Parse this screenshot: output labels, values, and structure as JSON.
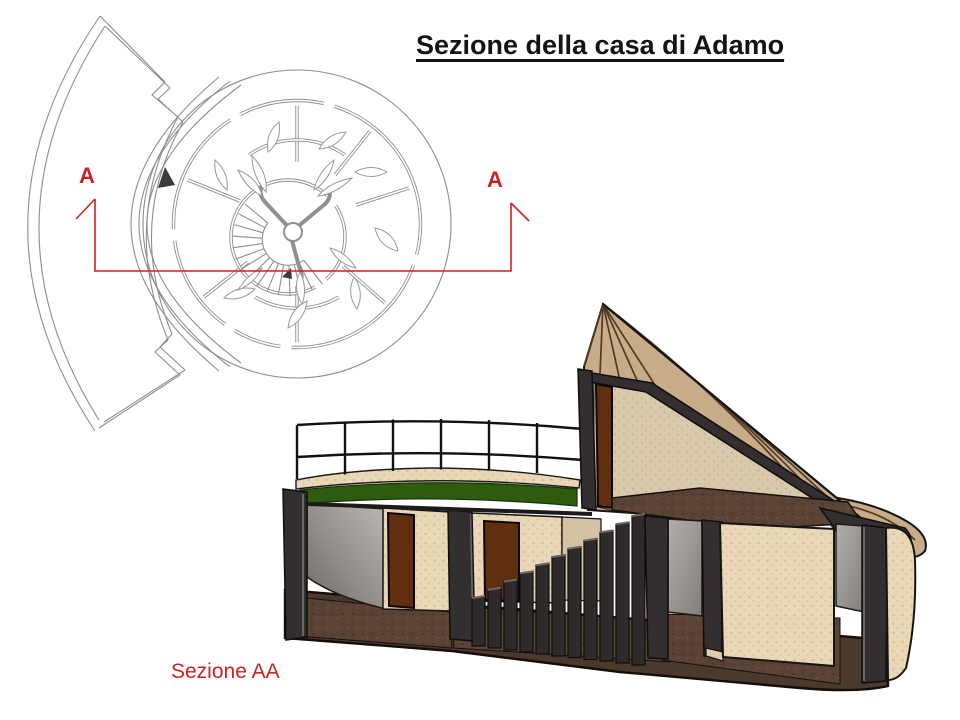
{
  "slide": {
    "title": "Sezione della casa di Adamo",
    "caption": "Sezione AA",
    "plan_marker_left": "A",
    "plan_marker_right": "A"
  },
  "colors": {
    "annotation-red": "#cc2222",
    "title-black": "#141414",
    "plan-line": "#8e8e8e",
    "roof-green": "#2e5b0e",
    "cone-tan": "#c8ab87",
    "wall-tan": "#e9d7b7",
    "inner-wall-tan": "#d9c9ac",
    "door-brown": "#5f2f10",
    "floor-brown": "#5a4335",
    "base-brown": "#4c392d",
    "cut-dark": "#332e2f",
    "gray-wall": "#a9a5a0",
    "stripe-brown": "#4f3b26"
  }
}
